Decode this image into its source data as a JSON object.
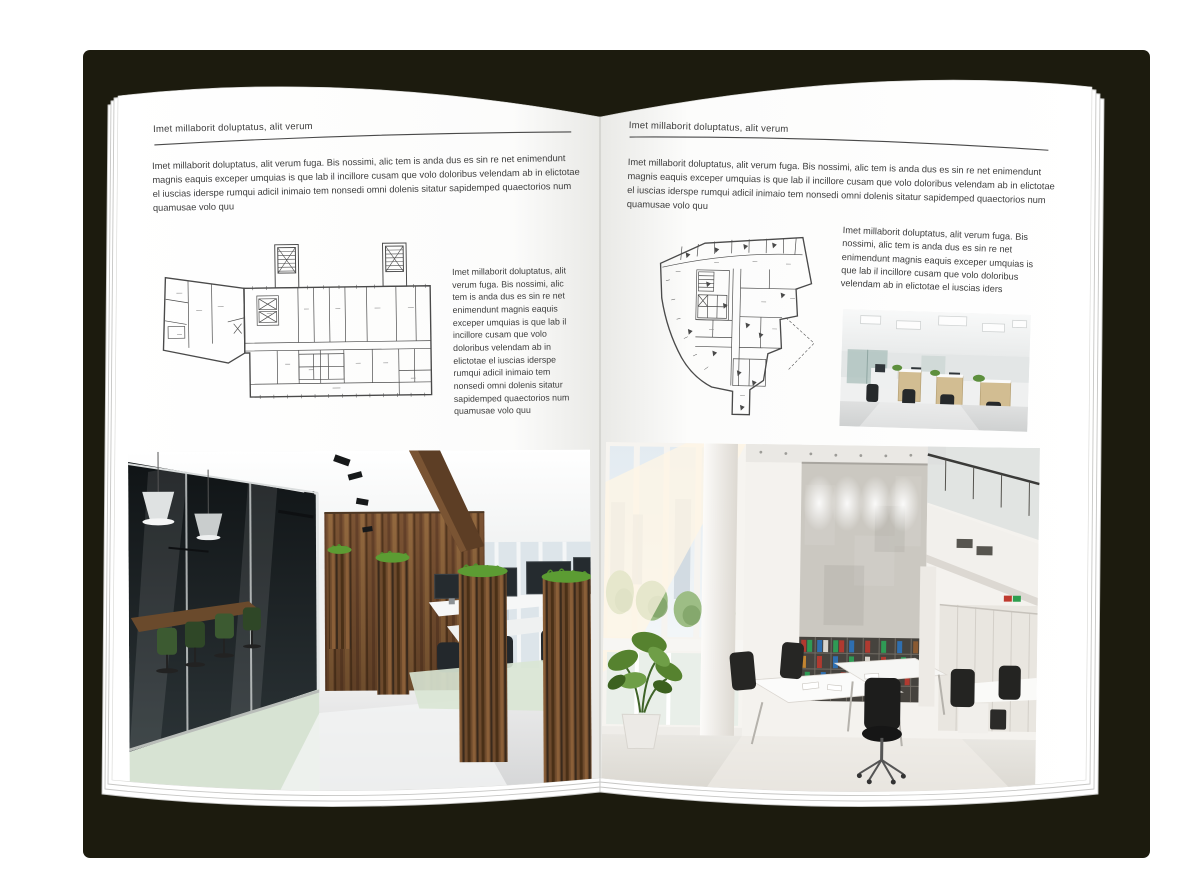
{
  "document": {
    "type": "brochure-spread-mockup",
    "left_page": {
      "header": "Imet millaborit doluptatus, alit verum",
      "body": "Imet millaborit doluptatus, alit verum fuga. Bis nossimi, alic tem is anda dus es sin re net enimendunt magnis eaquis exceper umquias is que lab il incillore cusam que volo doloribus velendam ab in elictotae el iuscias iderspe rumqui adicil inimaio tem nonsedi omni dolenis sitatur sapidemped quaectorios num quamusae volo quu",
      "side_text": "Imet millaborit doluptatus, alit verum fuga. Bis nossimi, alic tem is anda dus es sin re net enimendunt magnis eaquis exceper umquias is que lab il incillore cusam que volo doloribus velendam ab in elictotae el iuscias iderspe rumqui adicil inimaio tem nonsedi omni dolenis sitatur sapidemped quaectorios num quamusae volo quu"
    },
    "right_page": {
      "header": "Imet millaborit doluptatus, alit verum",
      "body": "Imet millaborit doluptatus, alit verum fuga. Bis nossimi, alic tem is anda dus es sin re net enimendunt magnis eaquis exceper umquias is que lab il incillore cusam que volo doloribus velendam ab in elictotae el iuscias iderspe rumqui adicil inimaio tem nonsedi omni dolenis sitatur sapidemped quaectorios num quamusae volo quu",
      "side_text": "Imet millaborit doluptatus, alit verum fuga. Bis nossimi, alic tem is anda dus es sin re net enimendunt magnis eaquis exceper umquias is que lab il incillore cusam que volo doloribus velendam ab in elictotae el iuscias iders"
    },
    "colors": {
      "background_shadow": "#1c1b0e",
      "page": "#ffffff",
      "text": "#3d3d3d",
      "header_rule": "#4a4a4a",
      "plan_lines": "#4a4a4a",
      "wood_wall": "#7c5434",
      "grass_green": "#4f8f2b",
      "binder_red": "#b03a30",
      "binder_green": "#2f9a55",
      "binder_blue": "#2f6fb0"
    }
  }
}
